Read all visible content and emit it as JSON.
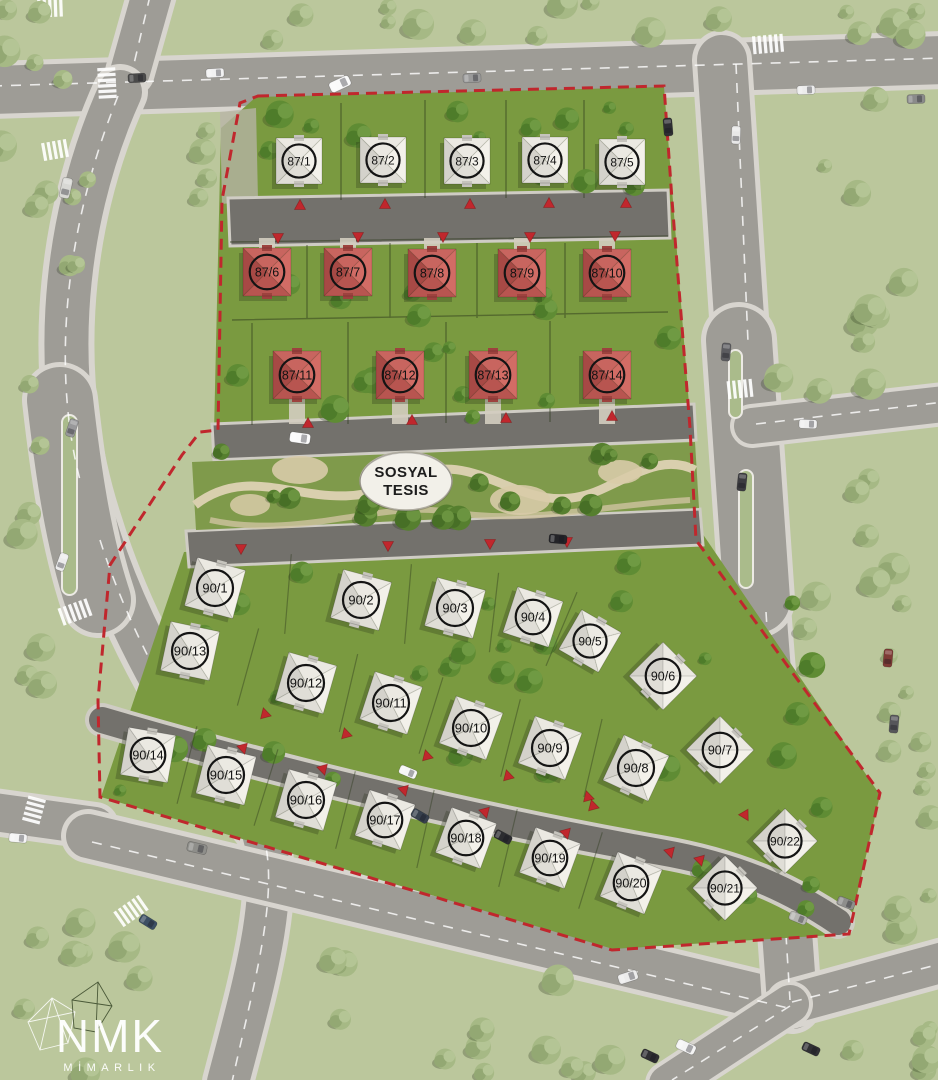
{
  "scene": {
    "width": 938,
    "height": 1080,
    "description": "Aerial 3D site plan render of a villa development with numbered lots"
  },
  "palette": {
    "boundary_red": "#c0272d",
    "roof_red": "#c5615c",
    "roof_red_dark": "#a74945",
    "roof_white": "#e9e7e0",
    "roof_white_dark": "#d4d2cb",
    "site_grass": "#7a9a40",
    "park_grass": "#7f9a4b",
    "outer_grass": "#b7c398",
    "road_outer": "#9e9c96",
    "road_inner": "#73716c",
    "sidewalk": "#d8d5cf",
    "label_ink": "#141414",
    "oval_fill": "#f2f0e9"
  },
  "park_label": {
    "line1": "SOSYAL",
    "line2": "TESIS"
  },
  "logo": {
    "title": "NMK",
    "subtitle": "MİMARLIK"
  },
  "houses": [
    {
      "id": "87/1",
      "x": 299,
      "y": 161,
      "rot": 0,
      "size": 46,
      "roof": "white"
    },
    {
      "id": "87/2",
      "x": 383,
      "y": 160,
      "rot": 0,
      "size": 46,
      "roof": "white"
    },
    {
      "id": "87/3",
      "x": 467,
      "y": 161,
      "rot": 0,
      "size": 46,
      "roof": "white"
    },
    {
      "id": "87/4",
      "x": 545,
      "y": 160,
      "rot": 0,
      "size": 46,
      "roof": "white"
    },
    {
      "id": "87/5",
      "x": 622,
      "y": 162,
      "rot": 0,
      "size": 46,
      "roof": "white"
    },
    {
      "id": "87/6",
      "x": 267,
      "y": 272,
      "rot": 0,
      "size": 48,
      "roof": "red"
    },
    {
      "id": "87/7",
      "x": 348,
      "y": 272,
      "rot": 0,
      "size": 48,
      "roof": "red"
    },
    {
      "id": "87/8",
      "x": 432,
      "y": 273,
      "rot": 0,
      "size": 48,
      "roof": "red"
    },
    {
      "id": "87/9",
      "x": 522,
      "y": 273,
      "rot": 0,
      "size": 48,
      "roof": "red"
    },
    {
      "id": "87/10",
      "x": 607,
      "y": 273,
      "rot": 0,
      "size": 48,
      "roof": "red"
    },
    {
      "id": "87/11",
      "x": 297,
      "y": 375,
      "rot": 0,
      "size": 48,
      "roof": "red"
    },
    {
      "id": "87/12",
      "x": 400,
      "y": 375,
      "rot": 0,
      "size": 48,
      "roof": "red"
    },
    {
      "id": "87/13",
      "x": 493,
      "y": 375,
      "rot": 0,
      "size": 48,
      "roof": "red"
    },
    {
      "id": "87/14",
      "x": 607,
      "y": 375,
      "rot": 0,
      "size": 48,
      "roof": "red"
    },
    {
      "id": "90/1",
      "x": 215,
      "y": 588,
      "rot": 15,
      "size": 50,
      "roof": "white"
    },
    {
      "id": "90/2",
      "x": 361,
      "y": 600,
      "rot": 15,
      "size": 50,
      "roof": "white"
    },
    {
      "id": "90/3",
      "x": 455,
      "y": 608,
      "rot": 15,
      "size": 50,
      "roof": "white"
    },
    {
      "id": "90/4",
      "x": 533,
      "y": 617,
      "rot": 18,
      "size": 48,
      "roof": "white"
    },
    {
      "id": "90/5",
      "x": 590,
      "y": 641,
      "rot": 30,
      "size": 46,
      "roof": "white"
    },
    {
      "id": "90/6",
      "x": 663,
      "y": 676,
      "rot": 45,
      "size": 48,
      "roof": "white"
    },
    {
      "id": "90/7",
      "x": 720,
      "y": 750,
      "rot": 45,
      "size": 48,
      "roof": "white"
    },
    {
      "id": "90/8",
      "x": 636,
      "y": 768,
      "rot": 25,
      "size": 50,
      "roof": "white"
    },
    {
      "id": "90/9",
      "x": 550,
      "y": 748,
      "rot": 20,
      "size": 50,
      "roof": "white"
    },
    {
      "id": "90/10",
      "x": 471,
      "y": 728,
      "rot": 20,
      "size": 50,
      "roof": "white"
    },
    {
      "id": "90/11",
      "x": 391,
      "y": 703,
      "rot": 18,
      "size": 50,
      "roof": "white"
    },
    {
      "id": "90/12",
      "x": 306,
      "y": 683,
      "rot": 16,
      "size": 50,
      "roof": "white"
    },
    {
      "id": "90/13",
      "x": 190,
      "y": 651,
      "rot": 12,
      "size": 50,
      "roof": "white"
    },
    {
      "id": "90/14",
      "x": 148,
      "y": 755,
      "rot": 10,
      "size": 48,
      "roof": "white"
    },
    {
      "id": "90/15",
      "x": 226,
      "y": 775,
      "rot": 14,
      "size": 50,
      "roof": "white"
    },
    {
      "id": "90/16",
      "x": 306,
      "y": 800,
      "rot": 16,
      "size": 50,
      "roof": "white"
    },
    {
      "id": "90/17",
      "x": 385,
      "y": 820,
      "rot": 18,
      "size": 48,
      "roof": "white"
    },
    {
      "id": "90/18",
      "x": 466,
      "y": 838,
      "rot": 20,
      "size": 48,
      "roof": "white"
    },
    {
      "id": "90/19",
      "x": 550,
      "y": 858,
      "rot": 20,
      "size": 48,
      "roof": "white"
    },
    {
      "id": "90/20",
      "x": 631,
      "y": 883,
      "rot": 22,
      "size": 48,
      "roof": "white"
    },
    {
      "id": "90/21",
      "x": 725,
      "y": 888,
      "rot": 45,
      "size": 46,
      "roof": "white"
    },
    {
      "id": "90/22",
      "x": 785,
      "y": 841,
      "rot": 45,
      "size": 46,
      "roof": "white"
    }
  ],
  "entrance_markers": [
    {
      "x": 300,
      "y": 206,
      "rot": 0
    },
    {
      "x": 385,
      "y": 205,
      "rot": 0
    },
    {
      "x": 470,
      "y": 205,
      "rot": 0
    },
    {
      "x": 549,
      "y": 204,
      "rot": 0
    },
    {
      "x": 626,
      "y": 204,
      "rot": 0
    },
    {
      "x": 278,
      "y": 237,
      "rot": 180
    },
    {
      "x": 358,
      "y": 236,
      "rot": 180
    },
    {
      "x": 443,
      "y": 236,
      "rot": 180
    },
    {
      "x": 530,
      "y": 236,
      "rot": 180
    },
    {
      "x": 615,
      "y": 235,
      "rot": 180
    },
    {
      "x": 308,
      "y": 424,
      "rot": 0
    },
    {
      "x": 412,
      "y": 421,
      "rot": 0
    },
    {
      "x": 506,
      "y": 419,
      "rot": 0
    },
    {
      "x": 612,
      "y": 417,
      "rot": 0
    },
    {
      "x": 241,
      "y": 548,
      "rot": 180
    },
    {
      "x": 388,
      "y": 545,
      "rot": 180
    },
    {
      "x": 490,
      "y": 543,
      "rot": 180
    },
    {
      "x": 567,
      "y": 541,
      "rot": 180
    },
    {
      "x": 265,
      "y": 714,
      "rot": -15
    },
    {
      "x": 346,
      "y": 734,
      "rot": -15
    },
    {
      "x": 427,
      "y": 756,
      "rot": -15
    },
    {
      "x": 508,
      "y": 776,
      "rot": -15
    },
    {
      "x": 588,
      "y": 797,
      "rot": -15
    },
    {
      "x": 243,
      "y": 748,
      "rot": 165
    },
    {
      "x": 323,
      "y": 769,
      "rot": 165
    },
    {
      "x": 404,
      "y": 790,
      "rot": 165
    },
    {
      "x": 485,
      "y": 812,
      "rot": 165
    },
    {
      "x": 566,
      "y": 833,
      "rot": 165
    },
    {
      "x": 593,
      "y": 806,
      "rot": -15
    },
    {
      "x": 700,
      "y": 860,
      "rot": 165
    },
    {
      "x": 745,
      "y": 815,
      "rot": 150
    },
    {
      "x": 670,
      "y": 852,
      "rot": 165
    }
  ]
}
